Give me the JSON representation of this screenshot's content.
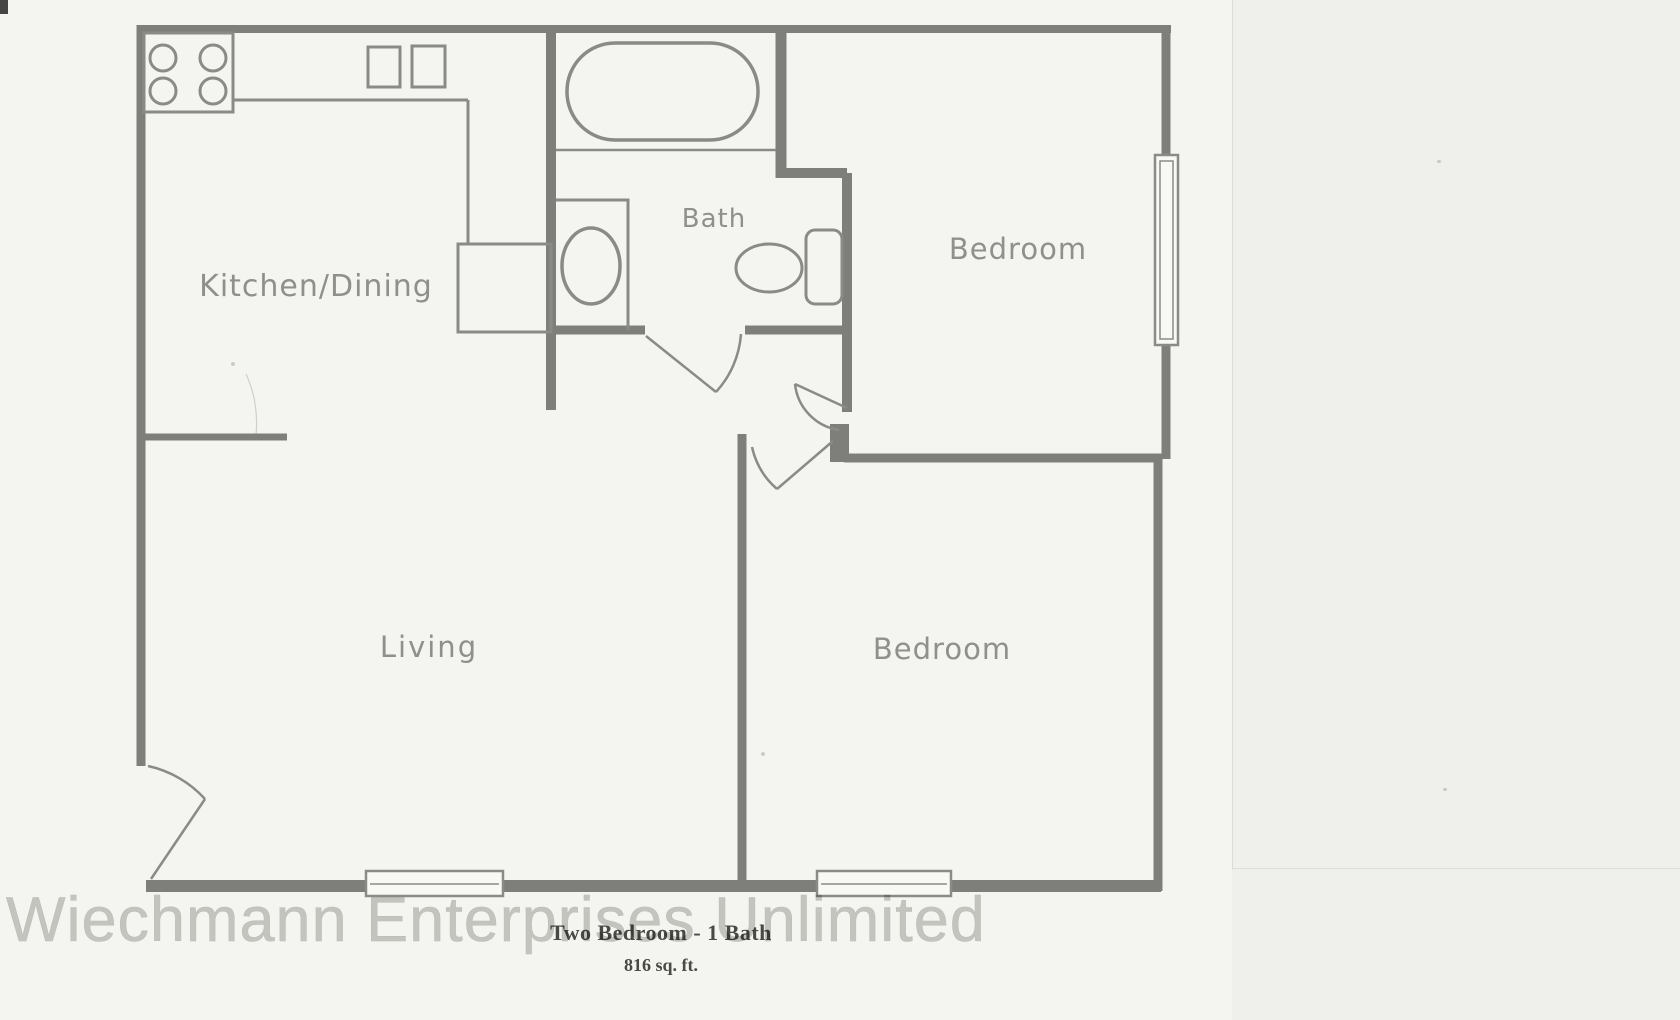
{
  "document_type": "apartment floor plan scan",
  "rooms": {
    "kitchen_dining": "Kitchen/Dining",
    "bath": "Bath",
    "bedroom_top": "Bedroom",
    "living": "Living",
    "bedroom_bottom": "Bedroom"
  },
  "caption": {
    "title": "Two Bedroom - 1 Bath",
    "area": "816 sq. ft."
  },
  "watermark": {
    "text": "Wiechmann Enterprises Unlimited",
    "color": "#c4c4c1"
  },
  "fixtures": [
    "stove",
    "kitchen-sink",
    "refrigerator",
    "bathtub",
    "vanity-sink",
    "toilet"
  ],
  "counts": {
    "windows": 3,
    "doors": 5
  },
  "colors": {
    "wall": "#7e7e7b",
    "thin_line": "#8a8a87",
    "room_label": "#8f8f8c",
    "caption_text": "#4a4a47",
    "paper": "#f4f4f1",
    "background": "#f0f1ed"
  }
}
